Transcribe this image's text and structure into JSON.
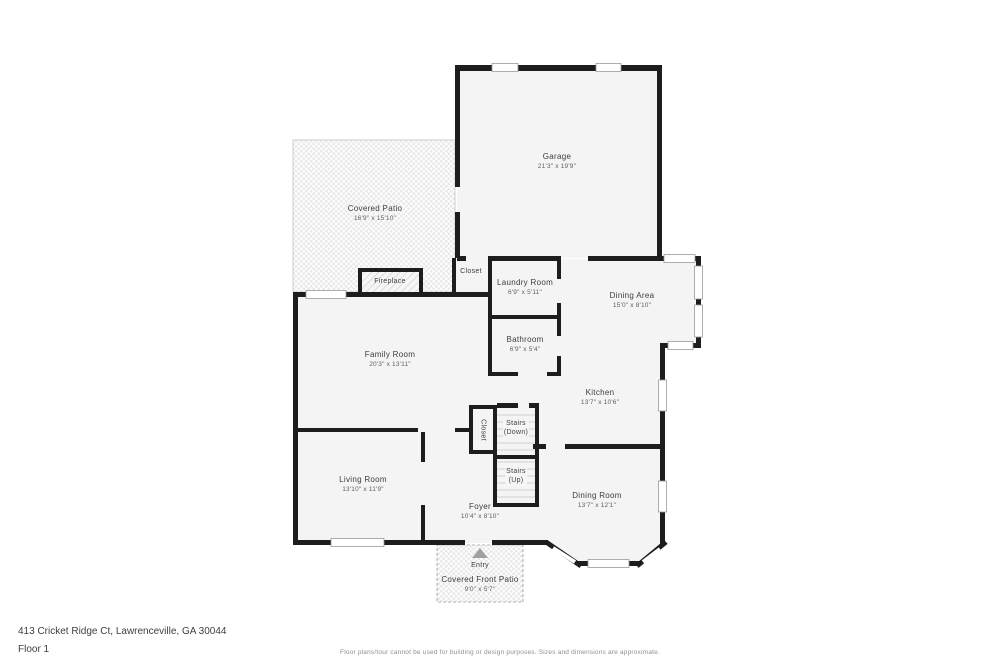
{
  "footer": {
    "address": "413 Cricket Ridge Ct, Lawrenceville, GA 30044",
    "floor": "Floor 1",
    "disclaimer": "Floor plans/tour cannot be used for building or design purposes. Sizes and dimensions are approximate."
  },
  "rooms": {
    "garage": {
      "name": "Garage",
      "dims": "21'3\" x 19'9\""
    },
    "covered_patio": {
      "name": "Covered Patio",
      "dims": "16'9\" x 15'10\""
    },
    "fireplace": {
      "name": "Fireplace"
    },
    "closet_entry": {
      "name": "Closet"
    },
    "laundry_room": {
      "name": "Laundry Room",
      "dims": "6'9\" x 5'11\""
    },
    "bathroom": {
      "name": "Bathroom",
      "dims": "6'9\" x 5'4\""
    },
    "dining_area": {
      "name": "Dining Area",
      "dims": "15'0\" x 8'10\""
    },
    "family_room": {
      "name": "Family Room",
      "dims": "20'3\" x 13'11\""
    },
    "kitchen": {
      "name": "Kitchen",
      "dims": "13'7\" x 10'6\""
    },
    "closet_stairs": {
      "name": "Closet"
    },
    "stairs_down": {
      "line1": "Stairs",
      "line2": "(Down)"
    },
    "stairs_up": {
      "line1": "Stairs",
      "line2": "(Up)"
    },
    "living_room": {
      "name": "Living Room",
      "dims": "13'10\" x 11'9\""
    },
    "foyer": {
      "name": "Foyer",
      "dims": "10'4\" x 8'10\""
    },
    "dining_room": {
      "name": "Dining Room",
      "dims": "13'7\" x 12'1\""
    },
    "entry": {
      "name": "Entry"
    },
    "front_patio": {
      "name": "Covered Front Patio",
      "dims": "9'0\" x 5'7\""
    }
  },
  "colors": {
    "wall": "#1d1d1d",
    "room_fill": "#f4f4f4",
    "label_text": "#3d3d3d",
    "dims_text": "#5f5f5f",
    "entry_arrow": "#a0a0a0"
  }
}
